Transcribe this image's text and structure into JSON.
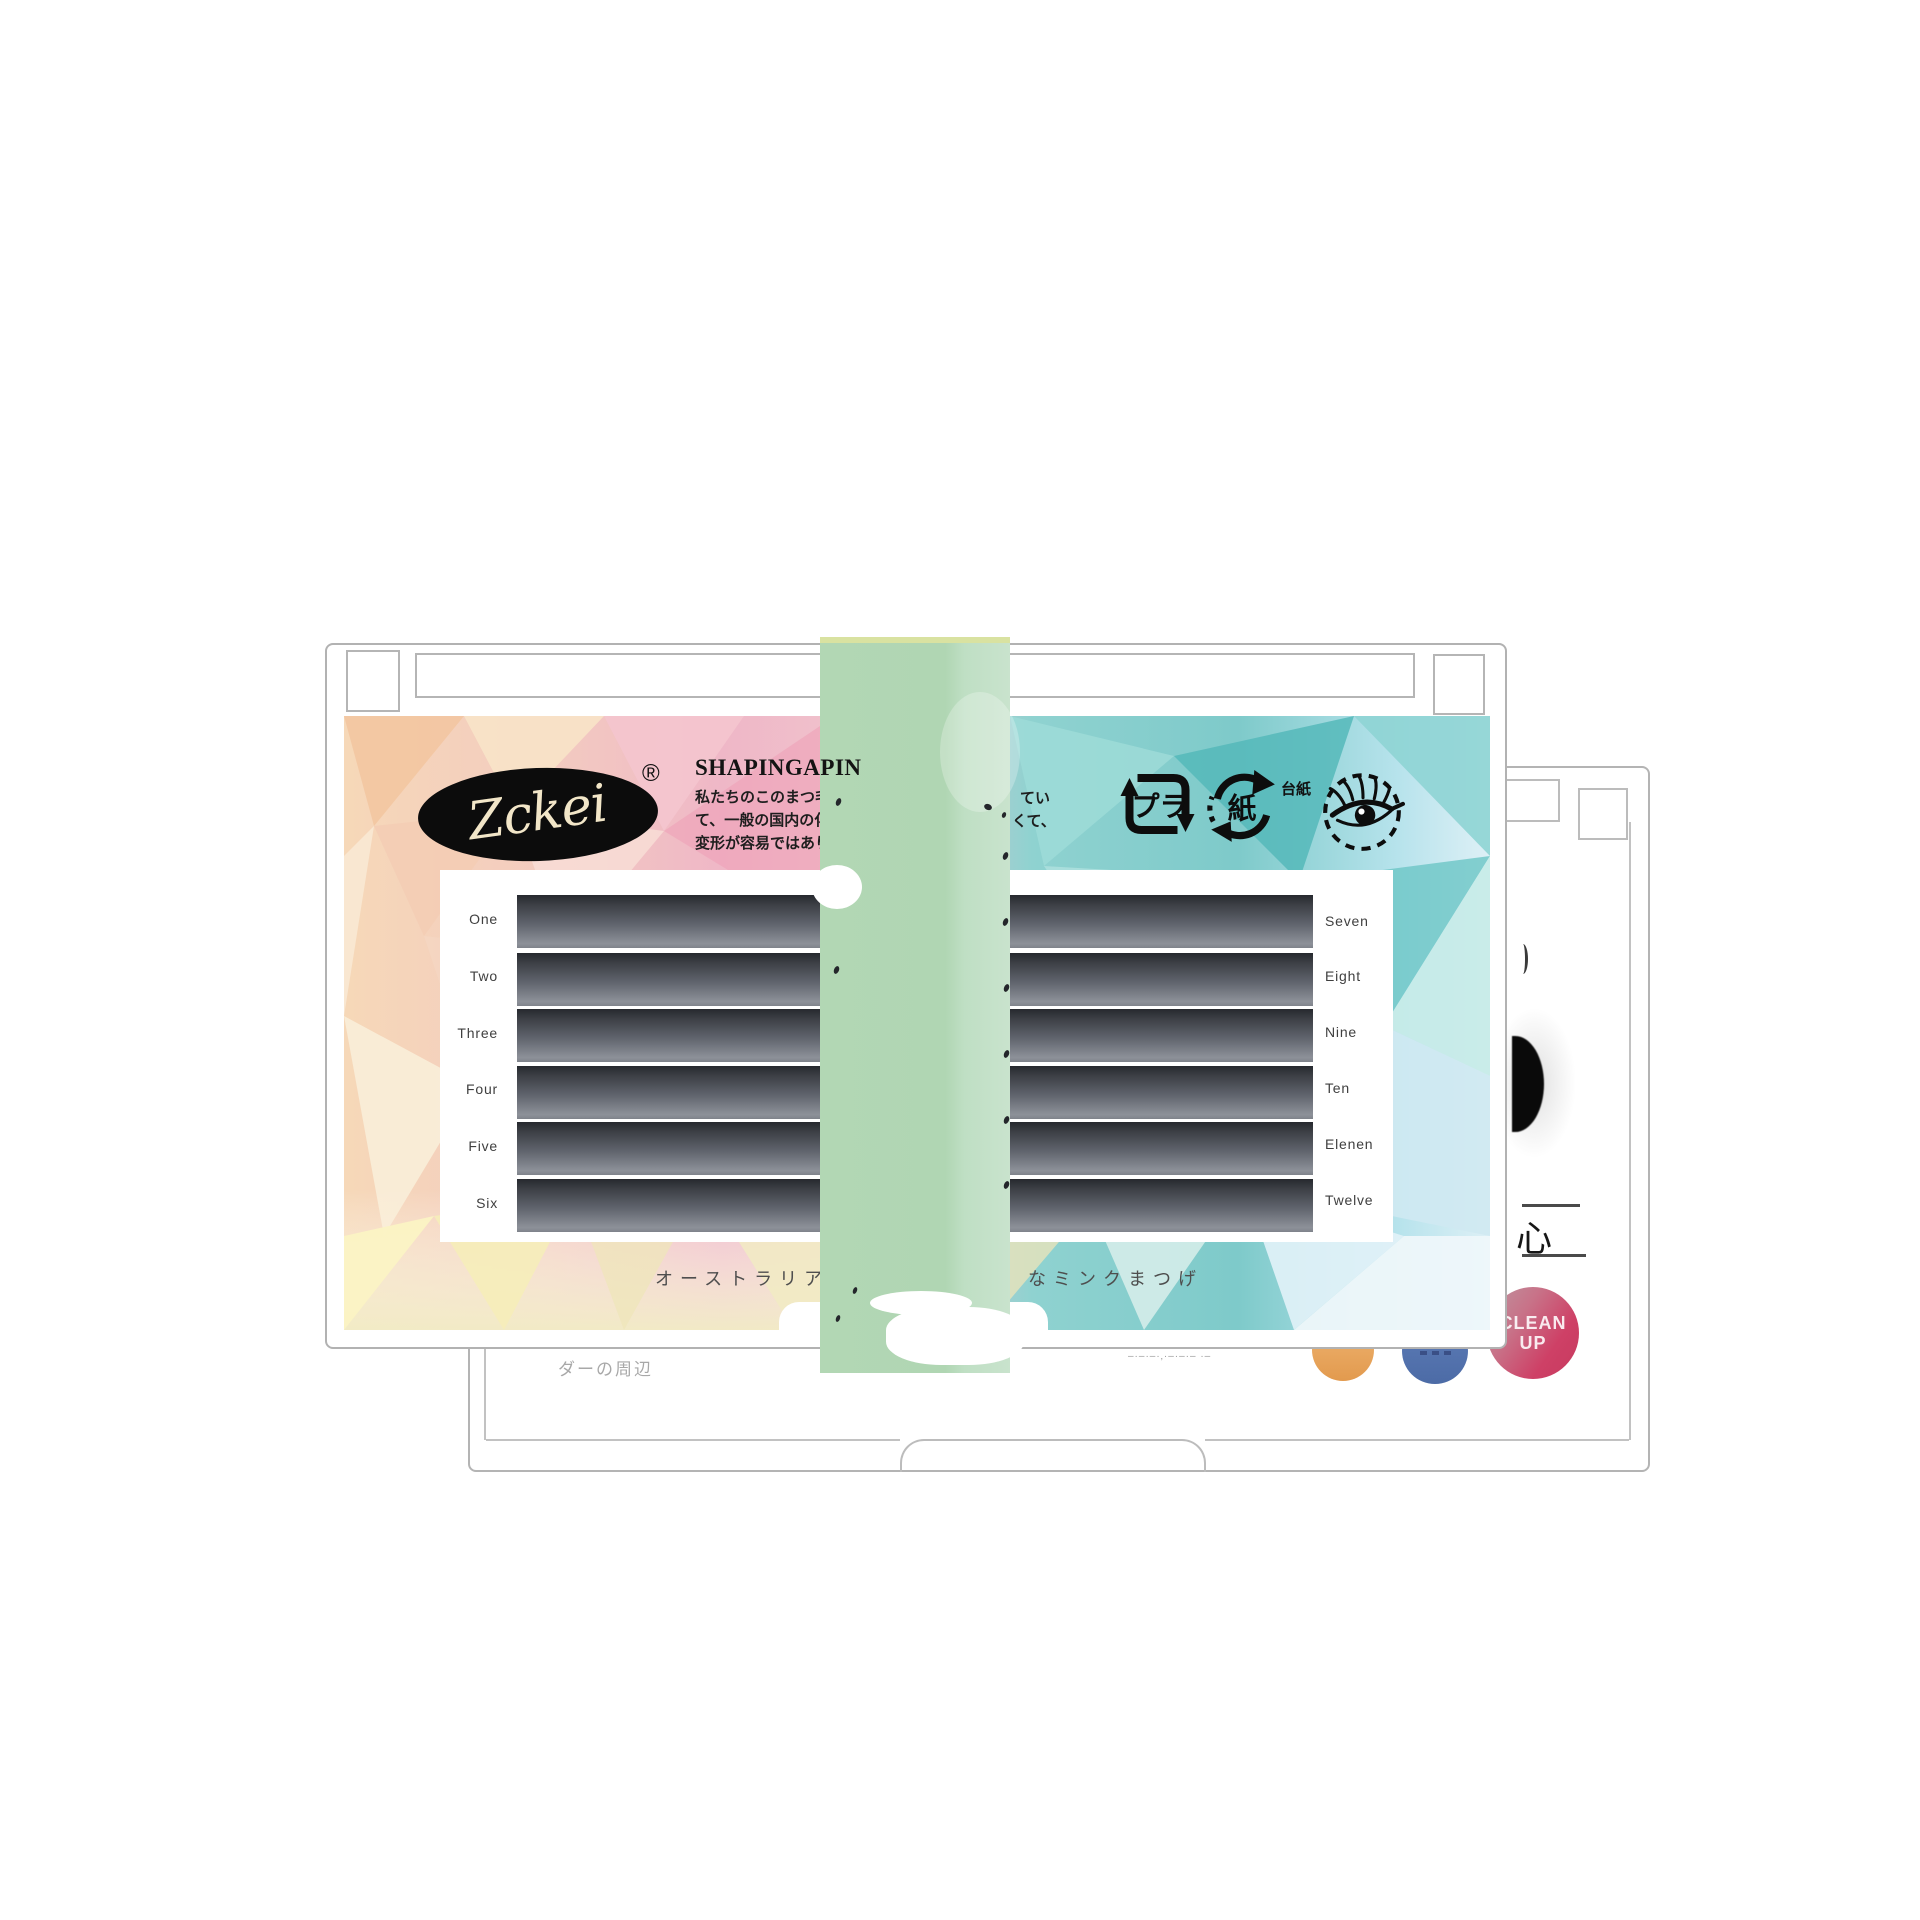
{
  "front_card": {
    "brand": {
      "logo_text": "Zckei",
      "registered_mark": "®"
    },
    "header": {
      "title_visible": "SHAPINGAPIN",
      "description_left_lines": [
        "私たちのこのまつ毛",
        "て、一般の国内の化",
        "変形が容易ではあり"
      ],
      "description_right_fragments": [
        "てい",
        "くて、"
      ],
      "icons": [
        {
          "name": "plastic-recycling-icon",
          "text": "プラ"
        },
        {
          "name": "paper-recycling-icon",
          "text": "紙",
          "label": "台紙"
        },
        {
          "name": "eye-lash-icon"
        }
      ]
    },
    "lash_tray": {
      "strip_count": 12,
      "left_rows": [
        "One",
        "Two",
        "Three",
        "Four",
        "Five",
        "Six"
      ],
      "right_rows": [
        "Seven",
        "Eight",
        "Nine",
        "Ten",
        "Elenen",
        "Twelve"
      ]
    },
    "footer": {
      "caption_left": "オーストラリア",
      "caption_right": "なミンクまつげ"
    }
  },
  "band": {
    "color": "#b2d7b4"
  },
  "back_card": {
    "heart_character": "心",
    "clean_up_badge": {
      "line1": "CLEAN",
      "line2": "UP"
    },
    "caption_left": "ダーの周辺",
    "caption_small_right": "–·–·–·‚·–·–·– ·–",
    "dot_colors": {
      "orange": "#ecac64",
      "blue": "#5372ad",
      "pink": "#ce4066"
    }
  },
  "colors": {
    "card_border": "#b2b2b2",
    "strip_dark": "#26292e",
    "strip_light": "#8d9199",
    "poly_pink": "#efb4c6",
    "poly_peach": "#f6dcc0",
    "poly_teal": "#7ecaca",
    "poly_yellow": "#f7eec2"
  }
}
